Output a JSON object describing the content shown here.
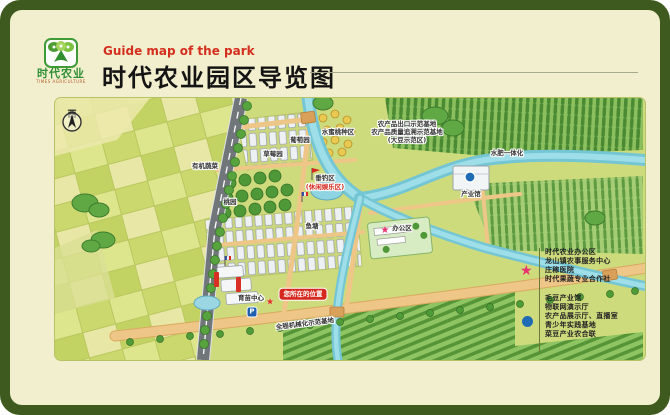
{
  "header": {
    "logo_name": "时代农业",
    "logo_sub": "TIMES AGRICULTURE",
    "subtitle_en": "Guide map of the park",
    "title": "时代农业园区导览图"
  },
  "map": {
    "compass": "西",
    "parking": "P",
    "you_are_here": "您所在的位置",
    "labels": [
      {
        "text": "葡萄园"
      },
      {
        "text": "草莓园"
      },
      {
        "text": "有机蔬菜"
      },
      {
        "text": "桃园"
      },
      {
        "text": "垂钓区"
      },
      {
        "text": "(休闲娱乐区)"
      },
      {
        "text": "水蜜桃种区"
      },
      {
        "text": "农产品出口示范基地"
      },
      {
        "text": "农产品质量追溯示范基地"
      },
      {
        "text": "(大豆示范区)"
      },
      {
        "text": "水肥一体化"
      },
      {
        "text": "产业馆"
      },
      {
        "text": "办公区"
      },
      {
        "text": "鱼塘"
      },
      {
        "text": "育苗中心"
      },
      {
        "text": "全程机械化示范基地"
      }
    ]
  },
  "legend": {
    "star_items": [
      "时代农业办公区",
      "龙山镇农事服务中心",
      "庄稼医院",
      "时代果蔬专业合作社"
    ],
    "dot_items": [
      "毛豆产业馆",
      "物联网演示厅",
      "农产品展示厅、直播室",
      "青少年实践基地",
      "菜豆产业农合联"
    ]
  },
  "colors": {
    "frame_green": "#3f5a1e",
    "card_cream": "#f2efce",
    "subtitle_red": "#d42f1e",
    "legend_star_pink": "#e8336e",
    "legend_dot_blue": "#1f6cb5",
    "badge_red": "#d5281e",
    "map_green": "#cedb7c"
  }
}
